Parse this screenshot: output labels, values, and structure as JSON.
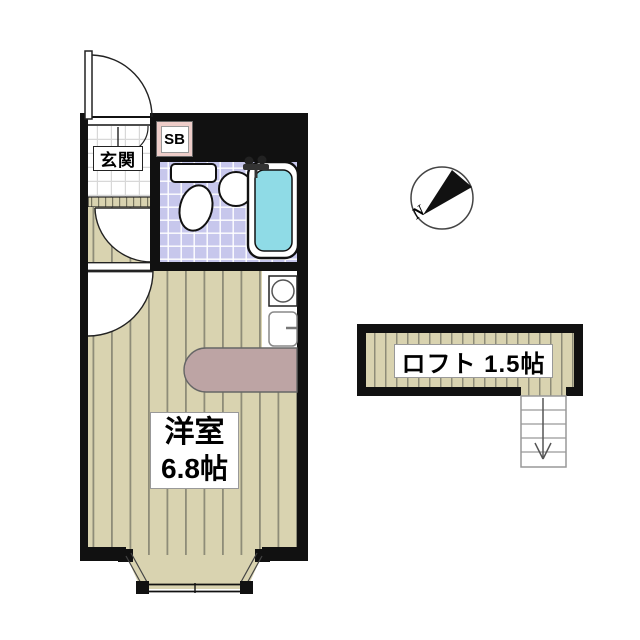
{
  "title": "間取り図",
  "labels": {
    "entrance": "玄関",
    "shoe_box": "SB",
    "room_name": "洋室",
    "room_size": "6.8帖",
    "loft": "ロフト 1.5帖",
    "north": "N"
  },
  "colors": {
    "wall": "#111111",
    "wood_floor": "#d9d3b0",
    "wood_stripe": "#8e8c78",
    "entrance_tile": "#ffffff",
    "bath_tile": "#c7c7ec",
    "bathtub_water": "#8fdbe6",
    "shoe_box_fill": "#eecdc9",
    "counter": "#bda4a4"
  },
  "fixtures": [
    {
      "name": "entrance-door"
    },
    {
      "name": "interior-doors"
    },
    {
      "name": "toilet"
    },
    {
      "name": "wash-basin"
    },
    {
      "name": "bathtub"
    },
    {
      "name": "stove"
    },
    {
      "name": "kitchen-sink"
    },
    {
      "name": "counter"
    },
    {
      "name": "bay-window"
    },
    {
      "name": "loft-stairs"
    },
    {
      "name": "compass"
    }
  ]
}
